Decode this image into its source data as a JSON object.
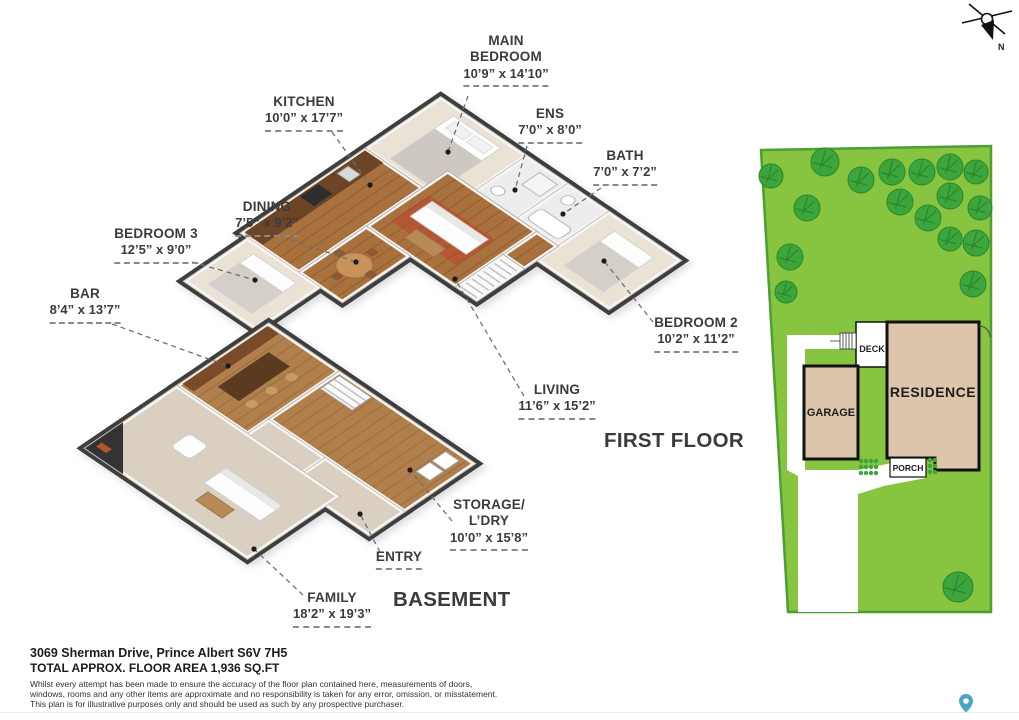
{
  "compass": {
    "label": "N"
  },
  "floor_titles": [
    {
      "id": "first-floor",
      "text": "FIRST FLOOR"
    },
    {
      "id": "basement",
      "text": "BASEMENT"
    }
  ],
  "room_labels": [
    {
      "id": "main-bedroom",
      "lines": [
        "MAIN",
        "BEDROOM"
      ],
      "dims": "10’9” x 14’10”",
      "x": 506,
      "y": 33,
      "leader": {
        "x1": 468,
        "y1": 96,
        "x2": 448,
        "y2": 152
      }
    },
    {
      "id": "kitchen",
      "lines": [
        "KITCHEN"
      ],
      "dims": "10’0” x 17’7”",
      "x": 304,
      "y": 94,
      "leader": {
        "x1": 332,
        "y1": 132,
        "x2": 370,
        "y2": 185
      }
    },
    {
      "id": "ens",
      "lines": [
        "ENS"
      ],
      "dims": "7’0” x 8’0”",
      "x": 550,
      "y": 106,
      "leader": {
        "x1": 527,
        "y1": 146,
        "x2": 515,
        "y2": 190
      }
    },
    {
      "id": "bath",
      "lines": [
        "BATH"
      ],
      "dims": "7’0” x 7’2”",
      "x": 625,
      "y": 148,
      "leader": {
        "x1": 601,
        "y1": 188,
        "x2": 563,
        "y2": 214
      }
    },
    {
      "id": "dining",
      "lines": [
        "DINING"
      ],
      "dims": "7’5” x 9’2”",
      "x": 267,
      "y": 199,
      "leader": {
        "x1": 291,
        "y1": 240,
        "x2": 356,
        "y2": 262
      }
    },
    {
      "id": "bedroom-3",
      "lines": [
        "BEDROOM 3"
      ],
      "dims": "12’5” x 9’0”",
      "x": 156,
      "y": 226,
      "leader": {
        "x1": 192,
        "y1": 262,
        "x2": 255,
        "y2": 280
      }
    },
    {
      "id": "bar",
      "lines": [
        "BAR"
      ],
      "dims": "8’4” x 13’7”",
      "x": 85,
      "y": 286,
      "leader": {
        "x1": 112,
        "y1": 324,
        "x2": 228,
        "y2": 366
      }
    },
    {
      "id": "bedroom-2",
      "lines": [
        "BEDROOM 2"
      ],
      "dims": "10’2” x 11’2”",
      "x": 696,
      "y": 315,
      "leader": {
        "x1": 653,
        "y1": 322,
        "x2": 604,
        "y2": 261
      }
    },
    {
      "id": "living",
      "lines": [
        "LIVING"
      ],
      "dims": "11’6” x 15’2”",
      "x": 557,
      "y": 382,
      "leader": {
        "x1": 524,
        "y1": 396,
        "x2": 455,
        "y2": 279
      }
    },
    {
      "id": "storage-ldry",
      "lines": [
        "STORAGE/",
        "L’DRY"
      ],
      "dims": "10’0” x 15’8”",
      "x": 489,
      "y": 497,
      "leader": {
        "x1": 452,
        "y1": 521,
        "x2": 410,
        "y2": 470
      }
    },
    {
      "id": "entry",
      "lines": [
        "ENTRY"
      ],
      "dims": null,
      "x": 399,
      "y": 549,
      "leader": {
        "x1": 380,
        "y1": 552,
        "x2": 360,
        "y2": 514
      }
    },
    {
      "id": "family",
      "lines": [
        "FAMILY"
      ],
      "dims": "18’2” x 19’3”",
      "x": 332,
      "y": 590,
      "leader": {
        "x1": 303,
        "y1": 595,
        "x2": 254,
        "y2": 549
      }
    }
  ],
  "site_plan": {
    "labels": {
      "deck": "DECK",
      "garage": "GARAGE",
      "residence": "RESIDENCE",
      "porch": "PORCH"
    },
    "trees": [
      {
        "x": 19,
        "y": 38,
        "r": 12
      },
      {
        "x": 73,
        "y": 24,
        "r": 14
      },
      {
        "x": 109,
        "y": 42,
        "r": 13
      },
      {
        "x": 140,
        "y": 34,
        "r": 13
      },
      {
        "x": 170,
        "y": 34,
        "r": 13
      },
      {
        "x": 198,
        "y": 29,
        "r": 13
      },
      {
        "x": 224,
        "y": 34,
        "r": 12
      },
      {
        "x": 148,
        "y": 64,
        "r": 13
      },
      {
        "x": 198,
        "y": 58,
        "r": 13
      },
      {
        "x": 228,
        "y": 70,
        "r": 12
      },
      {
        "x": 176,
        "y": 80,
        "r": 13
      },
      {
        "x": 198,
        "y": 101,
        "r": 12
      },
      {
        "x": 224,
        "y": 105,
        "r": 13
      },
      {
        "x": 55,
        "y": 70,
        "r": 13
      },
      {
        "x": 38,
        "y": 119,
        "r": 13
      },
      {
        "x": 34,
        "y": 154,
        "r": 11
      },
      {
        "x": 221,
        "y": 146,
        "r": 13
      },
      {
        "x": 206,
        "y": 449,
        "r": 15
      }
    ]
  },
  "footer": {
    "address": "3069 Sherman Drive, Prince Albert S6V 7H5",
    "area": "TOTAL APPROX. FLOOR AREA 1,936 SQ.FT",
    "disclaimer_lines": [
      "Whilst every attempt has been made to ensure the accuracy of the floor plan contained here, measurements of doors,",
      "windows, rooms and any other items are approximate and no responsibility is taken for any error, omission, or misstatement.",
      "This plan is for illustrative purposes only and should be used as such by any prospective purchaser."
    ]
  },
  "colors": {
    "lawn": "#87C440",
    "lawn_border": "#4D9E33",
    "tree": "#3CA53C",
    "tree_dark": "#2B862B",
    "building_tan": "#DCC5AB",
    "wall_dark": "#3E3E3E",
    "wood": "#A9713D",
    "carpet": "#D9D0C2",
    "label_text": "#3B3B3B",
    "pin_blue": "#4BA4C8",
    "rug_red": "#C0392B"
  }
}
